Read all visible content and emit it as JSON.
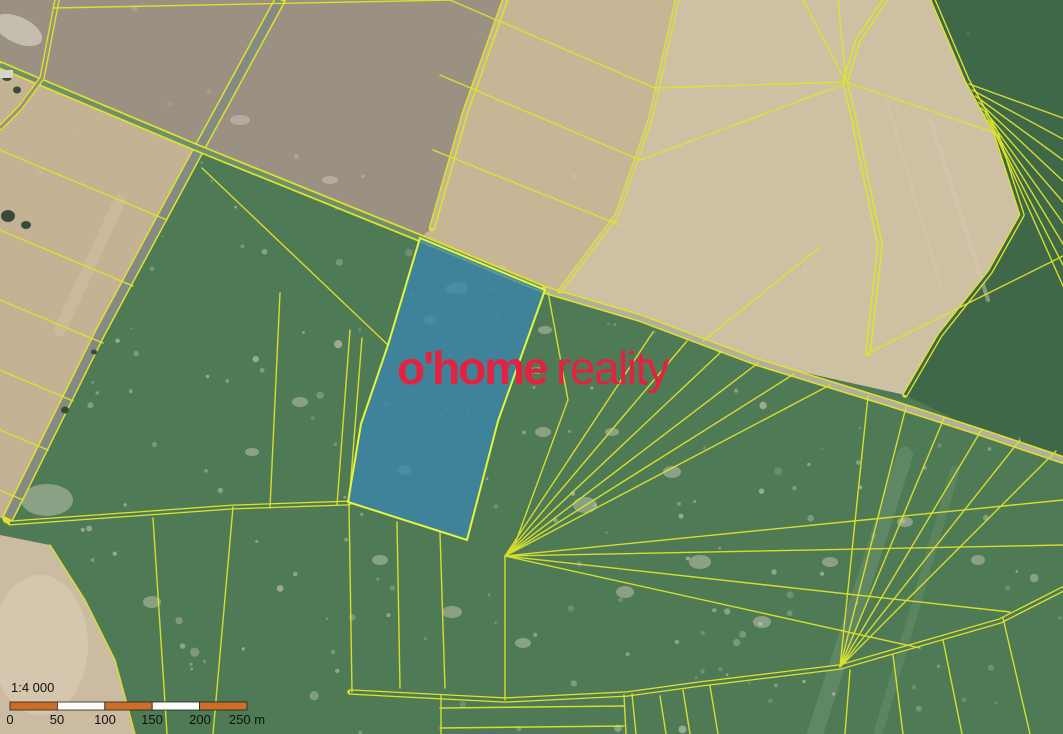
{
  "map": {
    "watermark": {
      "brand_bold": "o'home",
      "brand_light": "reality",
      "background_label": "úz"
    },
    "scale_bar": {
      "ratio": "1:4 000",
      "ticks": [
        "0",
        "50",
        "100",
        "150",
        "200",
        "250 m"
      ]
    },
    "colors": {
      "line-yellow": "#dfe32c",
      "field-green": "#4e7b55",
      "field-dark-green": "#3e6847",
      "field-gray-brown": "#9a9183",
      "field-tan-mid": "#c6b695",
      "field-tan-bright": "#cec0a2",
      "field-tan-wedge": "#c3b293",
      "field-tan-bottom": "#cbbca1",
      "road-gray": "#848b84",
      "track-light": "#b2b09c",
      "lane-green": "#6f8f6d",
      "parcel-blue": "#3a85ae",
      "parcel-blue-border": "#e4f63e",
      "brand-red": "#e42240",
      "scale-orange": "#cd6e28",
      "scale-white": "#fbfbf8"
    }
  }
}
